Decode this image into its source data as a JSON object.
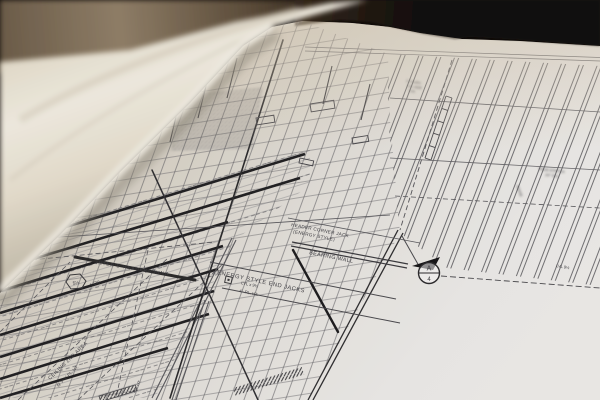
{
  "scene": {
    "description": "Close-up photograph of an architectural framing blueprint partially unrolled on a dark wooden table",
    "colors": {
      "room_background": "#0f0b08",
      "table_wood": "#8a7963",
      "rolled_paper": "#f3efe2",
      "sheet_paper": "#ecebe7",
      "drawing_ink": "#3b3b3f",
      "heavy_ink": "#1f1f22"
    }
  },
  "plan": {
    "labels": {
      "header_jack_line1": "HEADER CORNER JACK",
      "header_jack_line2": "(ENERGY STYLE)",
      "bearing_wall": "BEARING WALL",
      "end_jacks": "ENERGY STYLE END JACKS",
      "end_jacks_note1": "LVL x 9½",
      "end_jacks_note2": "4'- PL. HT.",
      "inter_header": "INTER'D HEADERS KING",
      "ceiling_line1": "CEILING 2ND AREA",
      "ceiling_line2": "@ 9'-1\" PL. HT.",
      "pl_ht": "PL. HT.",
      "dr_note": "+ DR",
      "truss_line1": "TRUS STRTCH",
      "truss_line2": "24\" O.C.",
      "ridge": "RIDGE",
      "lvl_note": "LVL 9½",
      "hdr_line1": "2-1¾x9½",
      "hdr_line2": "LVL HDR",
      "hdr_line3": "TYP."
    },
    "markers": {
      "section_circle_top": "A",
      "section_circle_bottom": "4",
      "hex_flag": "5½"
    }
  }
}
